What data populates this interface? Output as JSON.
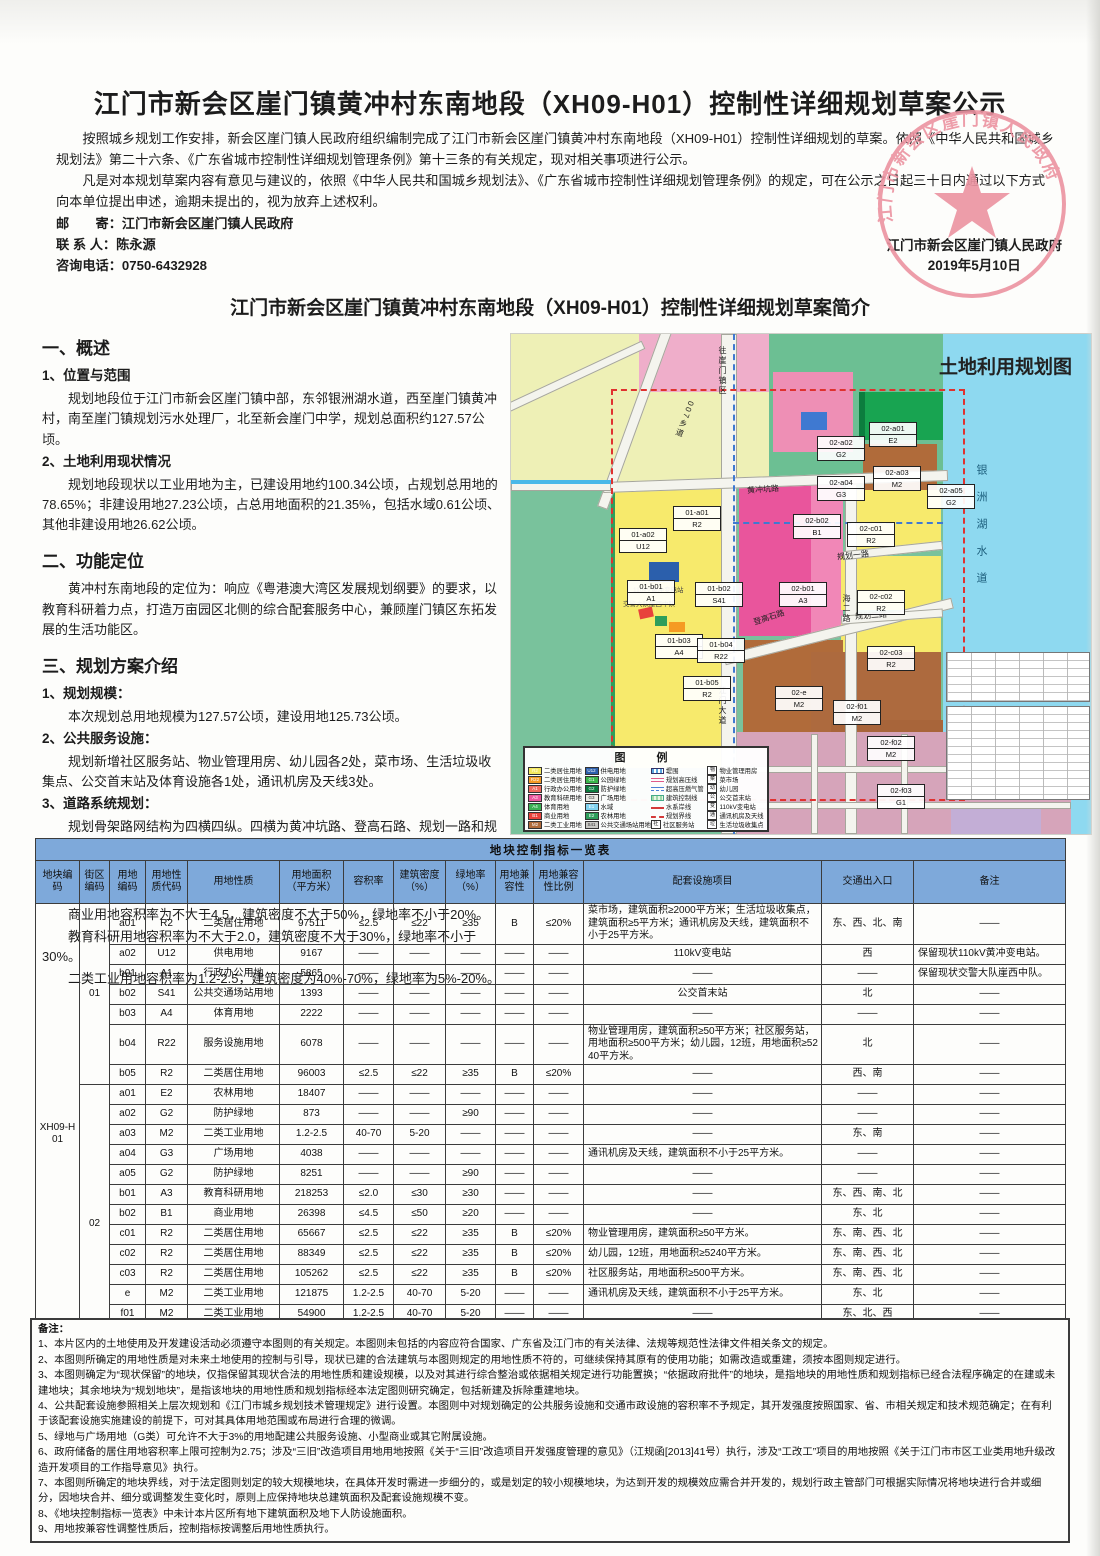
{
  "notice": {
    "title": "江门市新会区崖门镇黄冲村东南地段（XH09-H01）控制性详细规划草案公示",
    "para1": "按照城乡规划工作安排，新会区崖门镇人民政府组织编制完成了江门市新会区崖门镇黄冲村东南地段（XH09-H01）控制性详细规划的草案。依照《中华人民共和国城乡规划法》第二十六条、《广东省城市控制性详细规划管理条例》第十三条的有关规定，现对相关事项进行公示。",
    "para2": "凡是对本规划草案内容有意见与建议的，依照《中华人民共和国城乡规划法》、《广东省城市控制性详细规划管理条例》的规定，可在公示之日起三十日内通过以下方式向本单位提出申述，逾期未提出的，视为放弃上述权利。",
    "mail": "邮　　寄：江门市新会区崖门镇人民政府",
    "contact": "联 系 人：陈永源",
    "phone": "咨询电话：0750-6432928",
    "sign_org": "江门市新会区崖门镇人民政府",
    "sign_date": "2019年5月10日",
    "stamp_text": "江门市新会区崖门镇人民政府"
  },
  "brief": {
    "title": "江门市新会区崖门镇黄冲村东南地段（XH09-H01）控制性详细规划草案简介",
    "s1_head": "一、概述",
    "s1_1_head": "1、位置与范围",
    "s1_1_text": "规划地段位于江门市新会区崖门镇中部，东邻银洲湖水道，西至崖门镇黄冲村，南至崖门镇规划污水处理厂，北至新会崖门中学，规划总面积约127.57公顷。",
    "s1_2_head": "2、土地利用现状情况",
    "s1_2_text": "规划地段现状以工业用地为主，已建设用地约100.34公顷，占规划总用地的78.65%；非建设用地27.23公顷，占总用地面积的21.35%，包括水域0.61公顷、其他非建设用地26.62公顷。",
    "s2_head": "二、功能定位",
    "s2_text": "黄冲村东南地段的定位为：响应《粤港澳大湾区发展规划纲要》的要求，以教育科研着力点，打造万亩园区北侧的综合配套服务中心，兼顾崖门镇区东拓发展的生活功能区。",
    "s3_head": "三、规划方案介绍",
    "s3_1_head": "1、规划规模：",
    "s3_1_text": "本次规划总用地规模为127.57公顷，建设用地125.73公顷。",
    "s3_2_head": "2、公共服务设施：",
    "s3_2_text": "规划新增社区服务站、物业管理用房、幼儿园各2处，菜市场、生活垃圾收集点、公交首末站及体育设施各1处，通讯机房及天线3处。",
    "s3_3_head": "3、道路系统规划：",
    "s3_3_text": "规划骨架路网结构为四横四纵。四横为黄冲坑路、登高石路、规划一路和规划二路，四纵为007乡道、江门大道、海二路和银湖西路。",
    "s3_4_head": "4、开发强度：",
    "s3_4_lines": [
      "二类居住用地容积率不大于2.5，建筑密度不大于22%，绿地率不小于35%。",
      "商业用地容积率为不大于4.5，建筑密度不大于50%，绿地率不小于20%。",
      "教育科研用地容积率为不大于2.0，建筑密度不大于30%，绿地率不小于30%。",
      "二类工业用地容积率为1.2-2.5，建筑密度为40%-70%，绿地率为5%-20%。"
    ]
  },
  "map": {
    "title": "土地利用规划图",
    "water_label": "银洲湖水道",
    "station_label": "110kV黄冲变电站",
    "police_label": "交警大队崖西中队",
    "roads": [
      {
        "t": "往崖门镇区",
        "x": 206,
        "y": 12,
        "vert": true,
        "rot": 0
      },
      {
        "t": "007乡道",
        "x": 168,
        "y": 66,
        "vert": true,
        "rot": 20
      },
      {
        "t": "黄冲坑路",
        "x": 236,
        "y": 150,
        "vert": false,
        "rot": -4
      },
      {
        "t": "江门大道",
        "x": 206,
        "y": 352,
        "vert": true,
        "rot": 0
      },
      {
        "t": "登高石路",
        "x": 242,
        "y": 278,
        "vert": false,
        "rot": -18
      },
      {
        "t": "规划一路",
        "x": 326,
        "y": 216,
        "vert": false,
        "rot": -6
      },
      {
        "t": "规划二路",
        "x": 344,
        "y": 276,
        "vert": false,
        "rot": -4
      },
      {
        "t": "海二路",
        "x": 330,
        "y": 260,
        "vert": true,
        "rot": 0
      }
    ],
    "parcels": [
      {
        "code": "01-a01",
        "type": "R2",
        "x": 162,
        "y": 172
      },
      {
        "code": "01-a02",
        "type": "U12",
        "x": 108,
        "y": 194
      },
      {
        "code": "01-b01",
        "type": "A1",
        "x": 116,
        "y": 246
      },
      {
        "code": "01-b02",
        "type": "S41",
        "x": 184,
        "y": 248
      },
      {
        "code": "01-b03",
        "type": "A4",
        "x": 144,
        "y": 300
      },
      {
        "code": "01-b04",
        "type": "R22",
        "x": 186,
        "y": 304
      },
      {
        "code": "01-b05",
        "type": "R2",
        "x": 172,
        "y": 342
      },
      {
        "code": "02-a01",
        "type": "E2",
        "x": 358,
        "y": 88
      },
      {
        "code": "02-a02",
        "type": "G2",
        "x": 306,
        "y": 102
      },
      {
        "code": "02-a03",
        "type": "M2",
        "x": 362,
        "y": 132
      },
      {
        "code": "02-a04",
        "type": "G3",
        "x": 306,
        "y": 142
      },
      {
        "code": "02-a05",
        "type": "G2",
        "x": 416,
        "y": 150
      },
      {
        "code": "02-b01",
        "type": "A3",
        "x": 268,
        "y": 248
      },
      {
        "code": "02-b02",
        "type": "B1",
        "x": 282,
        "y": 180
      },
      {
        "code": "02-c01",
        "type": "R2",
        "x": 336,
        "y": 188
      },
      {
        "code": "02-c02",
        "type": "R2",
        "x": 346,
        "y": 256
      },
      {
        "code": "02-c03",
        "type": "R2",
        "x": 356,
        "y": 312
      },
      {
        "code": "02-e",
        "type": "M2",
        "x": 264,
        "y": 352
      },
      {
        "code": "02-f01",
        "type": "M2",
        "x": 322,
        "y": 366
      },
      {
        "code": "02-f02",
        "type": "M2",
        "x": 356,
        "y": 402
      },
      {
        "code": "02-f03",
        "type": "G1",
        "x": 366,
        "y": 450
      }
    ],
    "legend": {
      "title": "图　例",
      "col1": [
        {
          "code": "R2",
          "color": "#f5e95f",
          "label": "二类居住用地"
        },
        {
          "code": "R22",
          "color": "#f59a23",
          "label": "二类居住用地"
        },
        {
          "code": "A1",
          "color": "#ee6a5d",
          "label": "行政办公用地"
        },
        {
          "code": "A3",
          "color": "#ea579e",
          "label": "教育科研用地"
        },
        {
          "code": "A4",
          "color": "#3cb054",
          "label": "体育用地"
        },
        {
          "code": "B1",
          "color": "#e8413c",
          "label": "商业用地"
        },
        {
          "code": "M2",
          "color": "#b06b3a",
          "label": "二类工业用地"
        }
      ],
      "col2": [
        {
          "code": "U12",
          "color": "#2b5fac",
          "label": "供电用地"
        },
        {
          "code": "G1",
          "color": "#39b54a",
          "label": "公园绿地"
        },
        {
          "code": "G2",
          "color": "#0c7d3e",
          "label": "防护绿地"
        },
        {
          "code": "G3",
          "color": "#e8e8e2",
          "label": "广场用地"
        },
        {
          "code": "E1",
          "color": "#7fd1ee",
          "label": "水域"
        },
        {
          "code": "E2",
          "color": "#2e9e5b",
          "label": "农林用地"
        },
        {
          "code": "S41",
          "color": "#c8c8c4",
          "label": "公共交通场站用地"
        }
      ],
      "col3": [
        {
          "symbol": "sym-dike",
          "label": "堤围"
        },
        {
          "symbol": "sym-hv",
          "label": "规划高压线"
        },
        {
          "symbol": "sym-gas",
          "label": "超高压燃气管"
        },
        {
          "symbol": "sym-ctrl",
          "label": "建筑控制线"
        },
        {
          "symbol": "sym-water",
          "label": "水系岸线"
        },
        {
          "symbol": "sym-bound",
          "label": "规划界线"
        },
        {
          "symbol": "gbox:社",
          "label": "社区服务站"
        }
      ],
      "col4": [
        {
          "glyph": "物",
          "label": "物业管理用房"
        },
        {
          "glyph": "菜",
          "label": "菜市场"
        },
        {
          "glyph": "幼",
          "label": "幼儿园"
        },
        {
          "glyph": "公",
          "label": "公交首末站"
        },
        {
          "glyph": "变",
          "label": "110kV变电站"
        },
        {
          "glyph": "通",
          "label": "通讯机房及天线"
        },
        {
          "glyph": "垃",
          "label": "生活垃圾收集点"
        }
      ]
    }
  },
  "table": {
    "title": "地块控制指标一览表",
    "block_code": "XH09-H01",
    "headers": [
      "地块编码",
      "街区\n编码",
      "用地\n编码",
      "用地性\n质代码",
      "用地性质",
      "用地面积\n（平方米）",
      "容积率",
      "建筑密度\n（%）",
      "绿地率\n（%）",
      "用地兼\n容性",
      "用地兼容\n性比例",
      "配套设施项目",
      "交通出入口",
      "备注"
    ],
    "col_widths": [
      44,
      30,
      36,
      42,
      92,
      64,
      50,
      52,
      50,
      38,
      50,
      238,
      92,
      152
    ],
    "groups": [
      {
        "code": "01",
        "rows": [
          {
            "c": "a01",
            "t": "R2",
            "n": "二类居住用地",
            "area": "97511",
            "far": "≤2.5",
            "den": "≤22",
            "grn": "≥35",
            "cmp": "B",
            "rto": "≤20%",
            "fac": "菜市场，建筑面积≥2000平方米；生活垃圾收集点，建筑面积≥5平方米；通讯机房及天线，建筑面积不小于25平方米。",
            "acc": "东、西、北、南",
            "rmk": "——"
          },
          {
            "c": "a02",
            "t": "U12",
            "n": "供电用地",
            "area": "9167",
            "far": "——",
            "den": "——",
            "grn": "——",
            "cmp": "——",
            "rto": "——",
            "fac": "110kV变电站",
            "acc": "西",
            "rmk": "保留现状110kV黄冲变电站。"
          },
          {
            "c": "b01",
            "t": "A1",
            "n": "行政办公用地",
            "area": "5865",
            "far": "——",
            "den": "——",
            "grn": "——",
            "cmp": "——",
            "rto": "——",
            "fac": "——",
            "acc": "——",
            "rmk": "保留现状交警大队崖西中队。"
          },
          {
            "c": "b02",
            "t": "S41",
            "n": "公共交通场站用地",
            "area": "1393",
            "far": "——",
            "den": "——",
            "grn": "——",
            "cmp": "——",
            "rto": "——",
            "fac": "公交首末站",
            "acc": "北",
            "rmk": "——"
          },
          {
            "c": "b03",
            "t": "A4",
            "n": "体育用地",
            "area": "2222",
            "far": "——",
            "den": "——",
            "grn": "——",
            "cmp": "——",
            "rto": "——",
            "fac": "——",
            "acc": "——",
            "rmk": "——"
          },
          {
            "c": "b04",
            "t": "R22",
            "n": "服务设施用地",
            "area": "6078",
            "far": "——",
            "den": "——",
            "grn": "——",
            "cmp": "——",
            "rto": "——",
            "fac": "物业管理用房，建筑面积≥50平方米；社区服务站，用地面积≥500平方米；幼儿园，12班，用地面积≥5240平方米。",
            "acc": "北",
            "rmk": "——"
          },
          {
            "c": "b05",
            "t": "R2",
            "n": "二类居住用地",
            "area": "96003",
            "far": "≤2.5",
            "den": "≤22",
            "grn": "≥35",
            "cmp": "B",
            "rto": "≤20%",
            "fac": "——",
            "acc": "西、南",
            "rmk": "——"
          }
        ]
      },
      {
        "code": "02",
        "rows": [
          {
            "c": "a01",
            "t": "E2",
            "n": "农林用地",
            "area": "18407",
            "far": "——",
            "den": "——",
            "grn": "——",
            "cmp": "——",
            "rto": "——",
            "fac": "——",
            "acc": "——",
            "rmk": "——"
          },
          {
            "c": "a02",
            "t": "G2",
            "n": "防护绿地",
            "area": "873",
            "far": "——",
            "den": "——",
            "grn": "≥90",
            "cmp": "——",
            "rto": "——",
            "fac": "——",
            "acc": "——",
            "rmk": "——"
          },
          {
            "c": "a03",
            "t": "M2",
            "n": "二类工业用地",
            "area": "1.2-2.5",
            "far": "40-70",
            "den": "5-20",
            "grn": "——",
            "cmp": "——",
            "rto": "——",
            "fac": "——",
            "acc": "东、南",
            "rmk": "——"
          },
          {
            "c": "a04",
            "t": "G3",
            "n": "广场用地",
            "area": "4038",
            "far": "——",
            "den": "——",
            "grn": "——",
            "cmp": "——",
            "rto": "——",
            "fac": "通讯机房及天线，建筑面积不小于25平方米。",
            "acc": "——",
            "rmk": "——"
          },
          {
            "c": "a05",
            "t": "G2",
            "n": "防护绿地",
            "area": "8251",
            "far": "——",
            "den": "——",
            "grn": "≥90",
            "cmp": "——",
            "rto": "——",
            "fac": "——",
            "acc": "——",
            "rmk": "——"
          },
          {
            "c": "b01",
            "t": "A3",
            "n": "教育科研用地",
            "area": "218253",
            "far": "≤2.0",
            "den": "≤30",
            "grn": "≥30",
            "cmp": "——",
            "rto": "——",
            "fac": "——",
            "acc": "东、西、南、北",
            "rmk": "——"
          },
          {
            "c": "b02",
            "t": "B1",
            "n": "商业用地",
            "area": "26398",
            "far": "≤4.5",
            "den": "≤50",
            "grn": "≥20",
            "cmp": "——",
            "rto": "——",
            "fac": "——",
            "acc": "东、北",
            "rmk": "——"
          },
          {
            "c": "c01",
            "t": "R2",
            "n": "二类居住用地",
            "area": "65667",
            "far": "≤2.5",
            "den": "≤22",
            "grn": "≥35",
            "cmp": "B",
            "rto": "≤20%",
            "fac": "物业管理用房，建筑面积≥50平方米。",
            "acc": "东、南、西、北",
            "rmk": "——"
          },
          {
            "c": "c02",
            "t": "R2",
            "n": "二类居住用地",
            "area": "88349",
            "far": "≤2.5",
            "den": "≤22",
            "grn": "≥35",
            "cmp": "B",
            "rto": "≤20%",
            "fac": "幼儿园，12班，用地面积≥5240平方米。",
            "acc": "东、南、西、北",
            "rmk": "——"
          },
          {
            "c": "c03",
            "t": "R2",
            "n": "二类居住用地",
            "area": "105262",
            "far": "≤2.5",
            "den": "≤22",
            "grn": "≥35",
            "cmp": "B",
            "rto": "≤20%",
            "fac": "社区服务站，用地面积≥500平方米。",
            "acc": "东、南、西、北",
            "rmk": "——"
          },
          {
            "c": "e",
            "t": "M2",
            "n": "二类工业用地",
            "area": "121875",
            "far": "1.2-2.5",
            "den": "40-70",
            "grn": "5-20",
            "cmp": "——",
            "rto": "——",
            "fac": "通讯机房及天线，建筑面积不小于25平方米。",
            "acc": "东、北",
            "rmk": "——"
          },
          {
            "c": "f01",
            "t": "M2",
            "n": "二类工业用地",
            "area": "54900",
            "far": "1.2-2.5",
            "den": "40-70",
            "grn": "5-20",
            "cmp": "——",
            "rto": "——",
            "fac": "——",
            "acc": "东、北、西",
            "rmk": "——"
          },
          {
            "c": "f02",
            "t": "M2",
            "n": "二类工业用地",
            "area": "45475",
            "far": "——",
            "den": "——",
            "grn": "——",
            "cmp": "——",
            "rto": "——",
            "fac": "——",
            "acc": "——",
            "rmk": "按已有规划条件。"
          },
          {
            "c": "f03",
            "t": "G1",
            "n": "公园绿地",
            "area": "948",
            "far": "——",
            "den": "——",
            "grn": "——",
            "cmp": "——",
            "rto": "≥80",
            "fac": "——",
            "acc": "——",
            "rmk": "——"
          }
        ]
      }
    ]
  },
  "notes": {
    "label": "备注：",
    "items": [
      "1、本片区内的土地使用及开发建设活动必须遵守本图则的有关规定。本图则未包括的内容应符合国家、广东省及江门市的有关法律、法规等规范性法律文件相关条文的规定。",
      "2、本图则所确定的用地性质是对未来土地使用的控制与引导，现状已建的合法建筑与本图则规定的用地性质不符的，可继续保持其原有的使用功能；如需改造或重建，须按本图则规定进行。",
      "3、本图则确定为“现状保留”的地块，仅指保留其现状合法的用地性质和建设规模，以及对其进行综合整治或依据相关规定进行功能置换；“依据政府批件”的地块，是指地块的用地性质和规划指标已经合法程序确定的在建或未建地块；其余地块为“规划地块”，是指该地块的用地性质和规划指标经本法定图则研究确定，包括新建及拆除重建地块。",
      "4、公共配套设施参照相关上层次规划和《江门市城乡规划技术管理规定》进行设置。本图则中对规划确定的公共服务设施和交通市政设施的容积率不予规定，其开发强度按照国家、省、市相关规定和技术规范确定；在有利于该配套设施实施建设的前提下，可对其具体用地范围或布局进行合理的微调。",
      "5、绿地与广场用地（G类）可允许不大于3%的用地配建公共服务设施、小型商业或其它附属设施。",
      "6、政府储备的居住用地容积率上限可控制为2.75；涉及“三旧”改造项目用地用地按照《关于“三旧”改造项目开发强度管理的意见》（江规函[2013]41号）执行，涉及“工改工”项目的用地按照《关于江门市市区工业类用地升级改造开发项目的工作指导意见》执行。",
      "7、本图则所确定的地块界线，对于法定图则划定的较大规模地块，在具体开发时需进一步细分的，或是划定的较小规模地块，为达到开发的规模效应需合并开发的，规划行政主管部门可根据实际情况将地块进行合并或细分，因地块合并、细分或调整发生变化时，原则上应保持地块总建筑面积及配套设施规模不变。",
      "8、《地块控制指标一览表》中未计本片区所有地下建筑面积及地下人防设施面积。",
      "9、用地按兼容性调整性质后，控制指标按调整后用地性质执行。"
    ]
  }
}
